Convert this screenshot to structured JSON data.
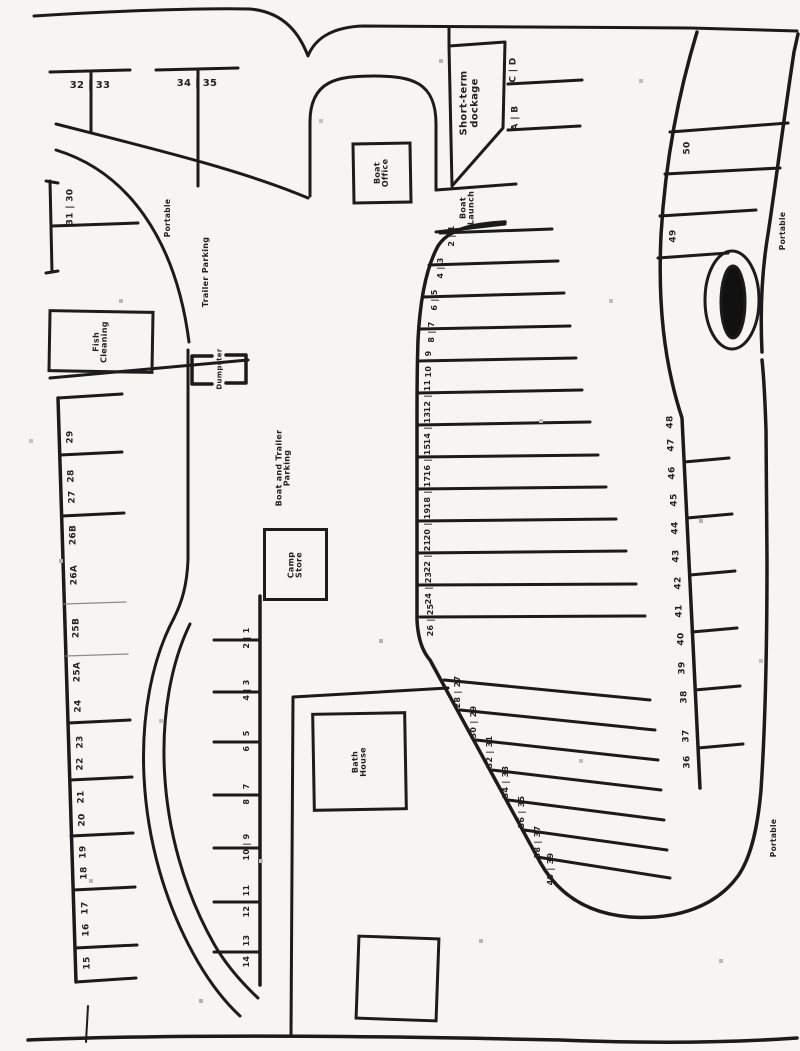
{
  "map": {
    "facilities": {
      "boat_office": "Boat Office",
      "fish_cleaning": "Fish Cleaning",
      "camp_store": "Camp Store",
      "bath_house": "Bath House",
      "dumpster": "Dumpster",
      "boat_launch": "Boat Launch",
      "short_term_dockage": "Short-term dockage"
    },
    "areas": {
      "trailer_parking": "Trailer Parking",
      "boat_and_trailer_parking": "Boat and Trailer Parking",
      "portable_top_left": "Portable",
      "portable_top_right": "Portable",
      "portable_bottom_right": "Portable"
    },
    "slips": {
      "t_dock_1": "32 | 33",
      "t_dock_2": "34 | 35",
      "dock_30_31": "31 | 30",
      "short_term_pairs": [
        "C | D",
        "A | B"
      ],
      "east_top": [
        "50",
        "49"
      ],
      "left_row": [
        "29",
        "28",
        "27",
        "26B",
        "26A",
        "25B",
        "25A",
        "24",
        "23",
        "22",
        "21",
        "20",
        "19",
        "18",
        "17",
        "16",
        "15"
      ],
      "middle_dock_pairs": [
        "2 | 1",
        "4 | 3",
        "6 | 5",
        "8 | 7",
        "10 | 9",
        "12 | 11",
        "14 | 13"
      ],
      "west_dock_pairs": [
        "2 | 1",
        "4 | 3",
        "6 | 5",
        "8 | 7",
        "10 | 9",
        "12 | 11",
        "14 | 13",
        "16 | 15",
        "18 | 17",
        "20 | 19",
        "22 | 21",
        "24 | 23",
        "26 | 25",
        "28 | 27",
        "30 | 29",
        "32 | 31",
        "34 | 33",
        "36 | 35",
        "38 | 37",
        "40 | 39"
      ],
      "east_row": [
        "48",
        "47",
        "46",
        "45",
        "44",
        "43",
        "42",
        "41",
        "40",
        "39",
        "38",
        "37",
        "36"
      ]
    }
  }
}
